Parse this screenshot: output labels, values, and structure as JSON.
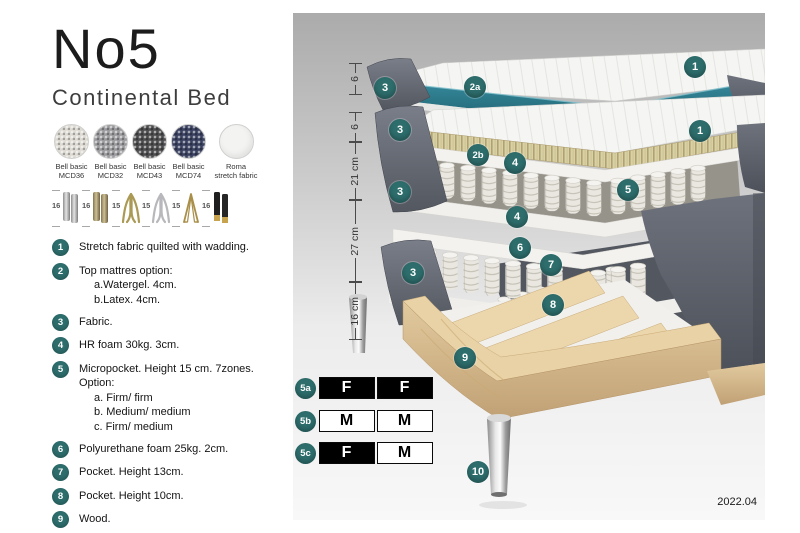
{
  "header": {
    "title": "No5",
    "subtitle": "Continental Bed"
  },
  "swatches": [
    {
      "name": "Bell basic",
      "code": "MCD36",
      "color": "#dedbd4"
    },
    {
      "name": "Bell basic",
      "code": "MCD32",
      "color": "#9b9b9f"
    },
    {
      "name": "Bell basic",
      "code": "MCD43",
      "color": "#4c4c4e"
    },
    {
      "name": "Bell basic",
      "code": "MCD74",
      "color": "#3a4160"
    },
    {
      "name": "Roma",
      "code": "stretch fabric",
      "color": "#f3f3f2"
    }
  ],
  "legs": [
    {
      "size": "16",
      "type": "cylinder-silver"
    },
    {
      "size": "16",
      "type": "cylinder-brass"
    },
    {
      "size": "15",
      "type": "splayed-gold"
    },
    {
      "size": "15",
      "type": "splayed-silver"
    },
    {
      "size": "15",
      "type": "hairpin-gold"
    },
    {
      "size": "16",
      "type": "cylinder-black-gold"
    }
  ],
  "features": [
    {
      "num": "1",
      "text": "Stretch fabric quilted with wadding.",
      "subs": []
    },
    {
      "num": "2",
      "text": "Top mattres option:",
      "subs": [
        "a.Watergel. 4cm.",
        "b.Latex. 4cm."
      ]
    },
    {
      "num": "3",
      "text": "Fabric.",
      "subs": []
    },
    {
      "num": "4",
      "text": "HR foam 30kg. 3cm.",
      "subs": []
    },
    {
      "num": "5",
      "text": "Micropocket. Height 15 cm. 7zones. Option:",
      "subs": [
        "a. Firm/ firm",
        "b. Medium/ medium",
        "c. Firm/ medium"
      ]
    },
    {
      "num": "6",
      "text": "Polyurethane foam 25kg. 2cm.",
      "subs": []
    },
    {
      "num": "7",
      "text": "Pocket. Height 13cm.",
      "subs": []
    },
    {
      "num": "8",
      "text": "Pocket. Height 10cm.",
      "subs": []
    },
    {
      "num": "9",
      "text": "Wood.",
      "subs": []
    },
    {
      "num": "10",
      "text": "Metal leg. Height 16cm.",
      "subs": []
    }
  ],
  "diagram": {
    "ruler": [
      "6",
      "6",
      "21 cm",
      "27 cm",
      "16 cm"
    ],
    "callouts": [
      "1",
      "3",
      "2a",
      "3",
      "1",
      "2b",
      "4",
      "5",
      "3",
      "4",
      "6",
      "7",
      "3",
      "8",
      "9",
      "10"
    ],
    "firmness": [
      {
        "id": "5a",
        "cells": [
          {
            "label": "F",
            "bg": "#000000",
            "fg": "#ffffff"
          },
          {
            "label": "F",
            "bg": "#000000",
            "fg": "#ffffff"
          }
        ]
      },
      {
        "id": "5b",
        "cells": [
          {
            "label": "M",
            "bg": "#ffffff",
            "fg": "#000000"
          },
          {
            "label": "M",
            "bg": "#ffffff",
            "fg": "#000000"
          }
        ]
      },
      {
        "id": "5c",
        "cells": [
          {
            "label": "F",
            "bg": "#000000",
            "fg": "#ffffff"
          },
          {
            "label": "M",
            "bg": "#ffffff",
            "fg": "#000000"
          }
        ]
      }
    ],
    "version": "2022.04"
  },
  "colors": {
    "accent": "#2d6d6c",
    "mattress_top_teal": "#2a7d8d",
    "latex": "#d8d0a6",
    "wood": "#ddc59a",
    "fabric_dark": "#5c606a"
  }
}
